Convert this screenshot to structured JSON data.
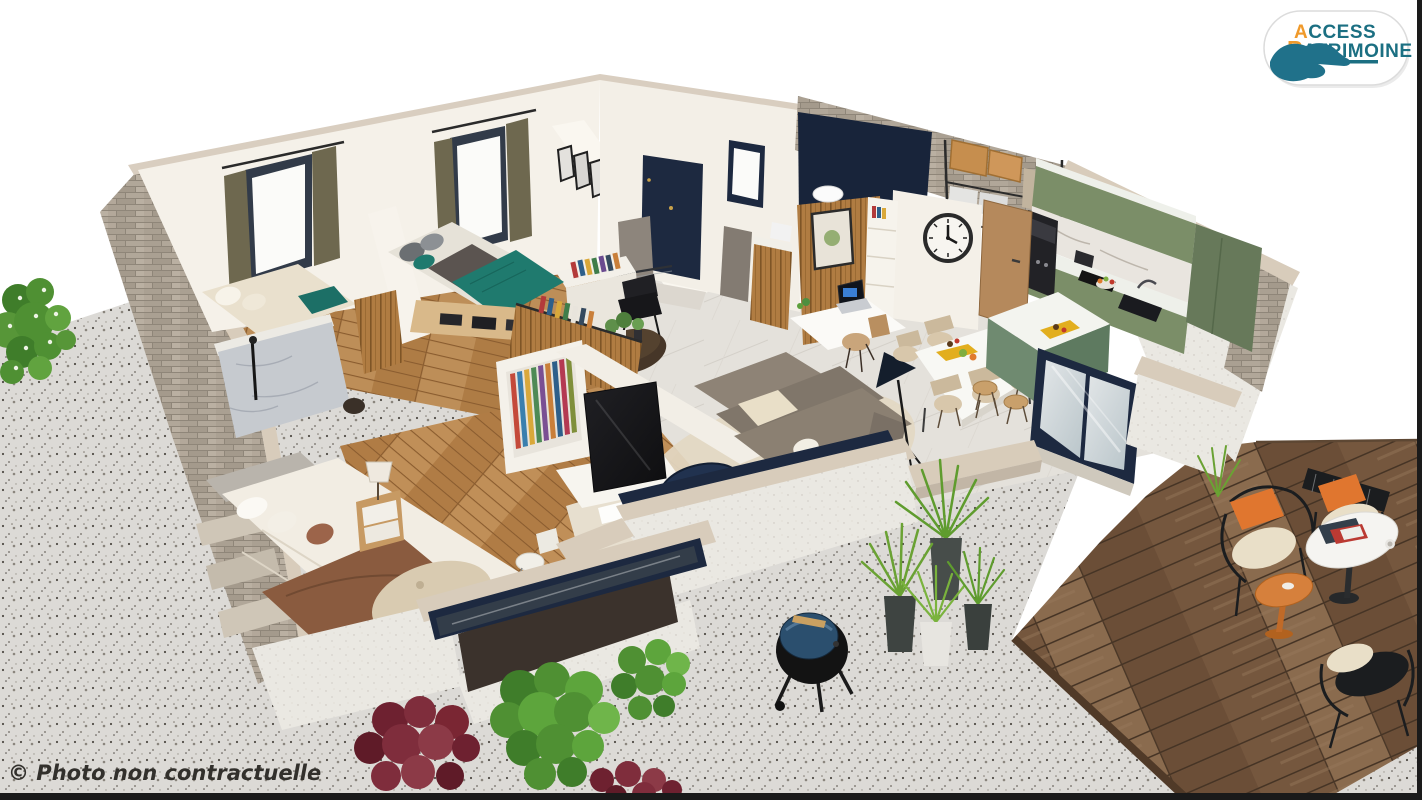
{
  "branding": {
    "line1_accent": "A",
    "line1_rest": "CCESS",
    "line2_accent": "P",
    "line2_rest": "ATRIMOINE",
    "icon": "hand-icon"
  },
  "watermark": {
    "text": "© Photo non contractuelle"
  },
  "scene": {
    "description": "isometric 3D cutaway render of a single-storey house with furnished rooms, gravel patio, barbecue and wooden terrace",
    "visible_elements": [
      "bedroom-with-teal-bed",
      "bedroom-with-cream-bed",
      "bedroom-with-white-bed",
      "bathroom-marble-shower",
      "entry-hall-navy-door",
      "office-nook-with-laptop",
      "wall-clock",
      "storage-room-boxes",
      "green-kitchen",
      "kitchen-island",
      "dining-table",
      "living-room-sofa",
      "tv",
      "glass-sliding-door",
      "wooden-terrace",
      "outdoor-chairs",
      "barbecue-grill",
      "bushes",
      "potted-grasses"
    ]
  },
  "colors": {
    "page_bg": "#ffffff",
    "border_bar": "#1a1a1a",
    "gravel_base": "#dcdad6",
    "deck_plank": "#7d5f45",
    "stone": "#b1a799",
    "travertine_cap": "#d8ccbb",
    "stucco": "#eae8e2",
    "interior_wall": "#f5f1e9",
    "marble_floor": "#e4e1db",
    "wood_floor": "#b5854f",
    "navy_accent": "#1d2940",
    "kitchen_green": "#7b8e68",
    "counter_white": "#eef0ea",
    "teal_bedding": "#1f7a6e",
    "sofa_taupe": "#8b8072",
    "cream_textile": "#e9dfc8",
    "rug_beige": "#d9cbb1",
    "throw_brown": "#8a5b3f",
    "curtain_olive": "#6e684f",
    "wood_slat": "#b07c42",
    "bush_green": "#4f9033",
    "bush_burgundy": "#7a2633",
    "cushion_orange": "#e0762f",
    "side_table_orange": "#d6803c",
    "logo_teal": "#1b6f82",
    "logo_orange": "#f09a2b",
    "watermark_text": "#32302c"
  }
}
